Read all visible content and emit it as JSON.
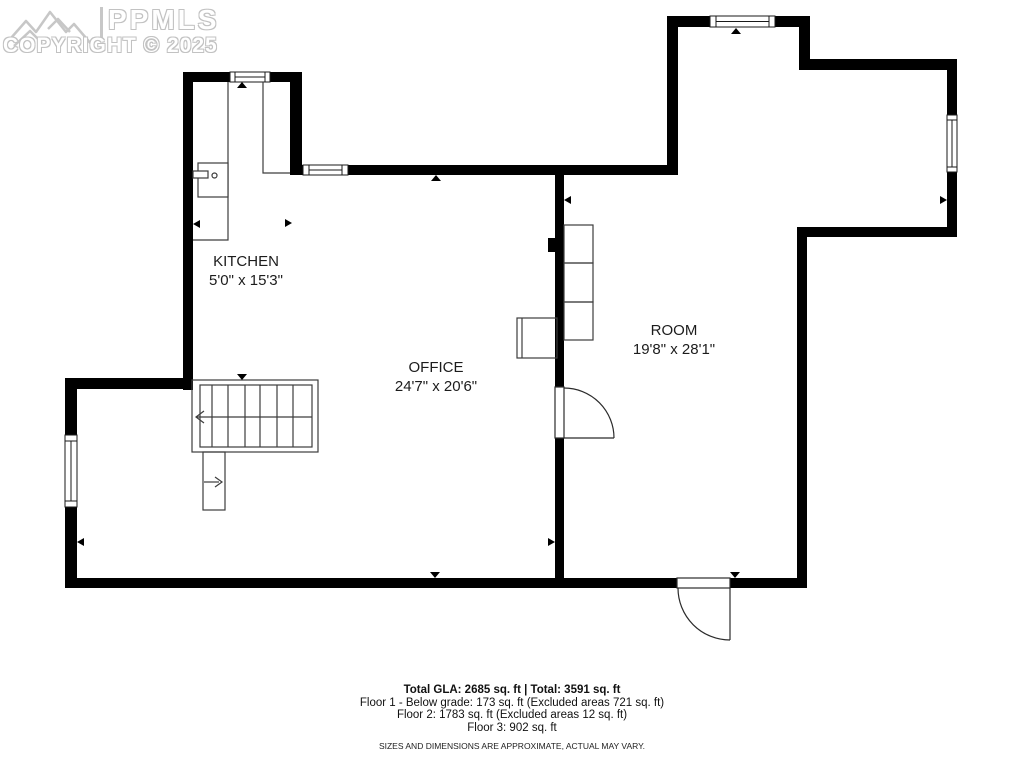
{
  "watermark": {
    "org": "PPMLS",
    "copyright": "COPYRIGHT © 2025"
  },
  "rooms": [
    {
      "name": "KITCHEN",
      "dimensions": "5'0\" x 15'3\""
    },
    {
      "name": "OFFICE",
      "dimensions": "24'7\" x 20'6\""
    },
    {
      "name": "ROOM",
      "dimensions": "19'8\" x 28'1\""
    }
  ],
  "footer": {
    "total_line": "Total GLA: 2685 sq. ft | Total: 3591 sq. ft",
    "floor1": "Floor 1 - Below grade: 173 sq. ft (Excluded areas 721 sq. ft)",
    "floor2": "Floor 2: 1783 sq. ft (Excluded areas 12 sq. ft)",
    "floor3": "Floor 3: 902 sq. ft",
    "disclaimer": "SIZES AND DIMENSIONS ARE APPROXIMATE, ACTUAL MAY VARY."
  },
  "colors": {
    "wall": "#000000",
    "thin_line": "#3d3d3d",
    "watermark_gray": "#c2c2c2"
  }
}
